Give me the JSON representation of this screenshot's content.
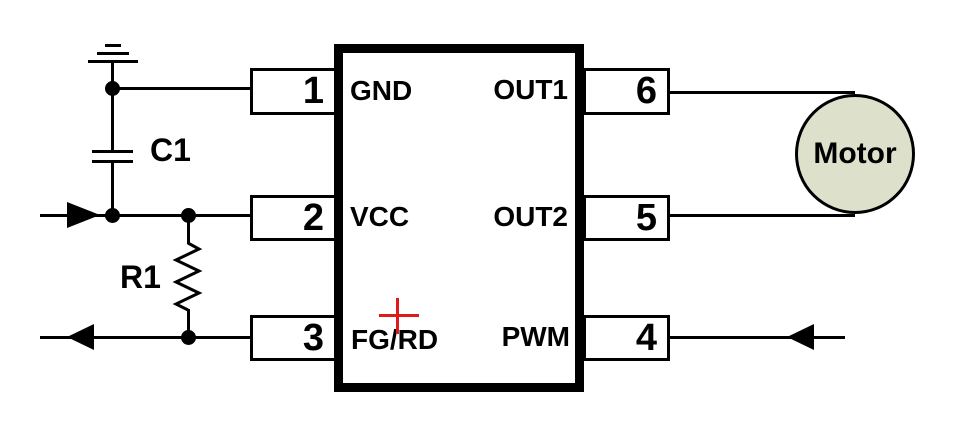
{
  "diagram": {
    "chip": {
      "pins_left": [
        {
          "number": "1",
          "label": "GND"
        },
        {
          "number": "2",
          "label": "VCC"
        },
        {
          "number": "3",
          "label": "FG/RD"
        }
      ],
      "pins_right": [
        {
          "number": "6",
          "label": "OUT1"
        },
        {
          "number": "5",
          "label": "OUT2"
        },
        {
          "number": "4",
          "label": "PWM"
        }
      ]
    },
    "components": {
      "capacitor": "C1",
      "resistor": "R1",
      "motor": "Motor"
    },
    "colors": {
      "line": "#000000",
      "background": "#ffffff",
      "motor_fill": "#dde1cc",
      "polarity_cross": "#dd1b1b"
    }
  }
}
